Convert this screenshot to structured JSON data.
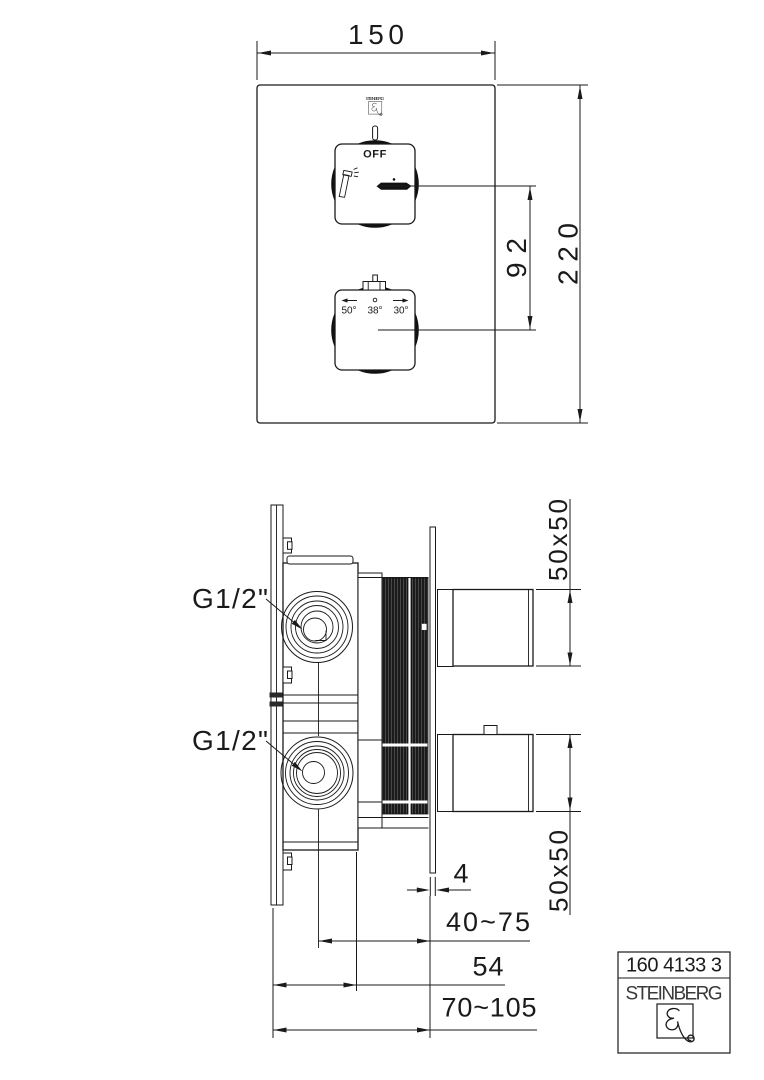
{
  "colors": {
    "background": "#ffffff",
    "line": "#1a1a1a",
    "fill_dark": "#111111"
  },
  "front_view": {
    "brand": "STEINBERG",
    "width_mm": "150",
    "height_mm": "220",
    "handle_spacing_mm": "92",
    "upper_handle": {
      "off_label": "OFF"
    },
    "lower_handle": {
      "temp_hot": "50°",
      "temp_neutral": "38°",
      "temp_cold": "30°"
    }
  },
  "side_view": {
    "upper_connection": "G1/2\"",
    "lower_connection": "G1/2\"",
    "upper_handle_size": "50x50",
    "lower_handle_size": "50x50",
    "plate_thickness": "4",
    "mounting_depth_range": "40~75",
    "body_depth": "54",
    "total_depth_range": "70~105"
  },
  "title_block": {
    "article_number": "160 4133 3",
    "brand": "STEINBERG"
  },
  "icons": {
    "brand_logo": "steinberg-swirl-logo",
    "hand_shower": "hand-shower-icon",
    "hot_direction": "arrow-left-icon",
    "neutral_marker": "circle-dot-icon",
    "cold_direction": "arrow-right-icon"
  }
}
